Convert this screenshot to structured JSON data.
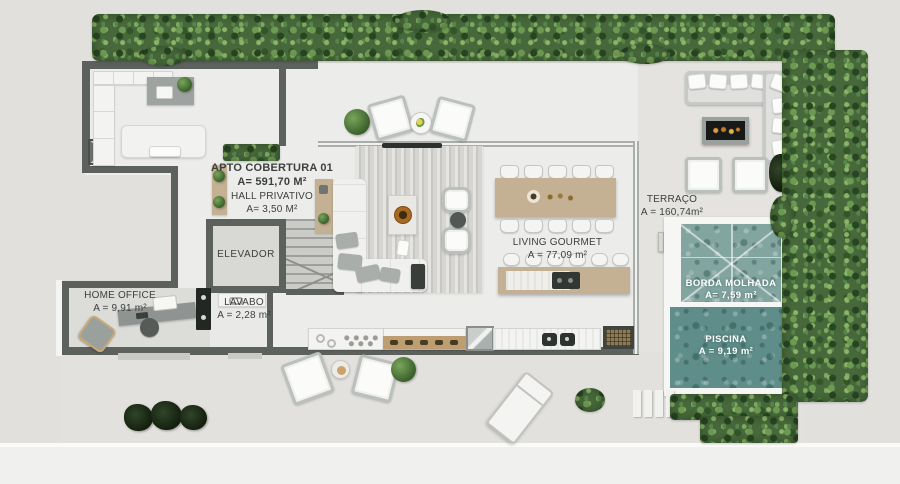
{
  "rooms": {
    "apto": {
      "name": "APTO COBERTURA 01",
      "area": "A= 591,70 M²"
    },
    "hall": {
      "name": "HALL PRIVATIVO",
      "area": "A= 3,50 M²"
    },
    "elevador": {
      "name": "ELEVADOR"
    },
    "lavabo": {
      "name": "LAVABO",
      "area": "A = 2,28 m²"
    },
    "home_office": {
      "name": "HOME OFFICE",
      "area": "A = 9,91 m²"
    },
    "living_gourmet": {
      "name": "LIVING GOURMET",
      "area": "A = 77,09 m²"
    },
    "terraco": {
      "name": "TERRAÇO",
      "area": "A = 160,74m²"
    },
    "borda_molhada": {
      "name": "BORDA MOLHADA",
      "area": "A= 7,59 m²"
    },
    "piscina": {
      "name": "PISCINA",
      "area": "A = 9,19 m²"
    }
  },
  "colors": {
    "wall": "#5c615e",
    "interior_floor": "#ececea",
    "terrace_floor": "#e4e3df",
    "deck_floor": "#e2e1dd",
    "hedge_green": "#46683a",
    "pool_shallow": "#83a5a0",
    "pool_deep": "#5f8d89",
    "wood_tan": "#c4b092",
    "label_text": "#3c403e",
    "pool_label_text": "#ffffff"
  }
}
